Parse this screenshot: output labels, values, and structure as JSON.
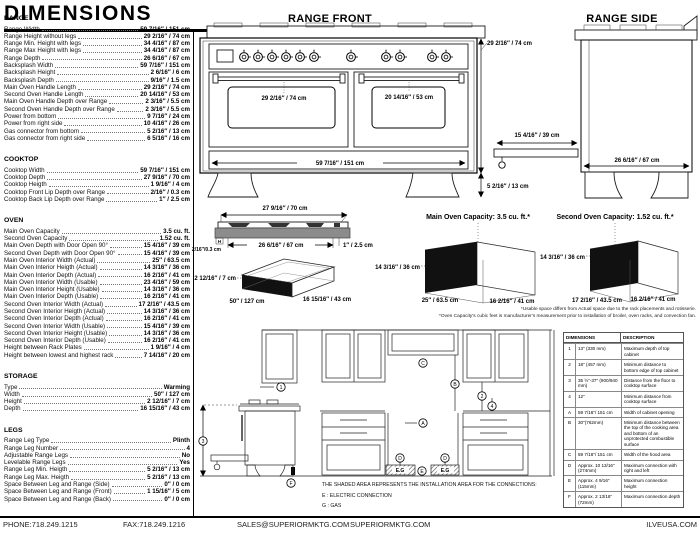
{
  "page_title": "DIMENSIONS",
  "specs": {
    "range": {
      "title": "RANGE",
      "rows": [
        {
          "label": "Range Width",
          "value": "59 7/16″ / 151 cm"
        },
        {
          "label": "Range Height without legs",
          "value": "29 2/16″ / 74 cm"
        },
        {
          "label": "Range Min. Height with legs",
          "value": "34 4/16″ / 87 cm"
        },
        {
          "label": "Range Max Height with legs",
          "value": "34 4/16″ / 87 cm"
        },
        {
          "label": "Range Depth",
          "value": "26 6/16″ / 67 cm"
        },
        {
          "label": "Backsplash Width",
          "value": "59 7/16″ / 151 cm"
        },
        {
          "label": "Backsplash Height",
          "value": "2 6/16″ / 6 cm"
        },
        {
          "label": "Backsplash Depth",
          "value": "9/16″ / 1.5 cm"
        },
        {
          "label": "Main Oven Handle Length",
          "value": "29 2/16″ / 74 cm"
        },
        {
          "label": "Second Oven Handle Length",
          "value": "20 14/16″ / 53 cm"
        },
        {
          "label": "Main Oven Handle Depth over Range",
          "value": "2 3/16″ / 5.5 cm"
        },
        {
          "label": "Second Oven Handle Depth over Range",
          "value": "2 3/16″ / 5.5 cm"
        },
        {
          "label": "Power from bottom",
          "value": "9 7/16″ / 24 cm"
        },
        {
          "label": "Power from right side",
          "value": "10 4/16″ / 26 cm"
        },
        {
          "label": "Gas connector from bottom",
          "value": "5 2/16″ / 13 cm"
        },
        {
          "label": "Gas connector from right side",
          "value": "6 5/16″ / 16 cm"
        }
      ]
    },
    "cooktop": {
      "title": "COOKTOP",
      "rows": [
        {
          "label": "Cooktop Width",
          "value": "59 7/16″ / 151 cm"
        },
        {
          "label": "Cooktop Depth",
          "value": "27 9/16″ / 70 cm"
        },
        {
          "label": "Cooktop Heigth",
          "value": "1 9/16″ / 4 cm"
        },
        {
          "label": "Cooktop Front Lip Depth over Range",
          "value": "2/16″ / 0.3 cm"
        },
        {
          "label": "Cooktop Back Lip Depth over Range",
          "value": "1″ / 2.5 cm"
        }
      ]
    },
    "oven": {
      "title": "OVEN",
      "rows": [
        {
          "label": "Main Oven Capacity",
          "value": "3.5 cu. ft."
        },
        {
          "label": "Second Oven Capacity",
          "value": "1.52 cu. ft."
        },
        {
          "label": "Main Oven Depth with Door Open 90°",
          "value": "15 4/16″ / 39 cm"
        },
        {
          "label": "Second Oven Depth with Door Open 90°",
          "value": "15 4/16″ / 39 cm"
        },
        {
          "label": "Main Oven Interior Width (Actual)",
          "value": "25″ / 63.5 cm"
        },
        {
          "label": "Main Oven Interior Heigth (Actual)",
          "value": "14 3/16″ / 36 cm"
        },
        {
          "label": "Main Oven Interior Depth (Actual)",
          "value": "16 2/16″ / 41 cm"
        },
        {
          "label": "Main Oven Interior Width (Usable)",
          "value": "23 4/16″ / 59 cm"
        },
        {
          "label": "Main Oven Interior Height (Usable)",
          "value": "14 3/16″ / 36 cm"
        },
        {
          "label": "Main Oven Interior Depth (Usable)",
          "value": "16 2/16″ / 41 cm"
        },
        {
          "label": "Second Oven Interior Width (Actual)",
          "value": "17 2/16″ / 43.5 cm"
        },
        {
          "label": "Second Oven Interior Heigth (Actual)",
          "value": "14 3/16″ / 36 cm"
        },
        {
          "label": "Second Oven Interior Depth (Actual)",
          "value": "16 2/16″ / 41 cm"
        },
        {
          "label": "Second Oven Interior Width (Usable)",
          "value": "15 4/16″ / 39 cm"
        },
        {
          "label": "Second Oven Interior Height (Usable)",
          "value": "14 3/16″ / 36 cm"
        },
        {
          "label": "Second Oven Interior Depth (Usable)",
          "value": "16 2/16″ / 41 cm"
        },
        {
          "label": "Height between Rack Plates",
          "value": "1 9/16″ / 4 cm"
        },
        {
          "label": "Height between lowest and highest rack",
          "value": "7 14/16″ / 20 cm"
        }
      ]
    },
    "storage": {
      "title": "STORAGE",
      "rows": [
        {
          "label": "Type",
          "value": "Warming"
        },
        {
          "label": "Width",
          "value": "50″ / 127 cm"
        },
        {
          "label": "Height",
          "value": "2 12/16″ / 7 cm"
        },
        {
          "label": "Depth",
          "value": "16 15/16″ / 43 cm"
        }
      ]
    },
    "legs": {
      "title": "LEGS",
      "rows": [
        {
          "label": "Range Leg Type",
          "value": "Plinth"
        },
        {
          "label": "Range Leg Number",
          "value": "4"
        },
        {
          "label": "Adjustable Range Legs",
          "value": "No"
        },
        {
          "label": "Levelable Range Legs",
          "value": "Yes"
        },
        {
          "label": "Range Leg Min. Heigth",
          "value": "5 2/16″ / 13 cm"
        },
        {
          "label": "Range Leg Max. Heigth",
          "value": "5 2/16″ / 13 cm"
        },
        {
          "label": "Space Between Leg and Range (Side)",
          "value": "0″ / 0 cm"
        },
        {
          "label": "Space Between Leg and Range (Front)",
          "value": "1 15/16″ / 5 cm"
        },
        {
          "label": "Space Between Leg and Range (Back)",
          "value": "0″ / 0 cm"
        }
      ]
    }
  },
  "front_diagram": {
    "title": "RANGE FRONT",
    "height_label": "29 2/16″ / 74 cm",
    "main_handle_label": "29 2/16″ / 74 cm",
    "second_handle_label": "20 14/16″ / 53 cm",
    "width_label": "59 7/16″ / 151 cm",
    "leg_height_label": "5 2/16″ / 13 cm"
  },
  "side_diagram": {
    "title": "RANGE SIDE",
    "depth_label": "26 6/16″ / 67 cm",
    "door_open_label": "15 4/16″ / 39 cm"
  },
  "cooktop_diagram": {
    "top_width_label": "27 9/16″ / 70 cm",
    "bottom_width_label": "26 6/16″ / 67 cm",
    "back_lip_label": "1″ / 2.5 cm",
    "front_lip_label": "2/16″/0.3 cm",
    "front_lip_pointer": "H"
  },
  "storage_diagram": {
    "height_label": "2 12/16″ / 7 cm",
    "width_label": "50″ / 127 cm",
    "depth_label": "16 15/16″ / 43 cm"
  },
  "main_oven_diagram": {
    "title": "Main Oven Capacity: 3.5 cu. ft.*",
    "height_label": "14 3/16″ / 36 cm",
    "width_label": "25″ / 63.5 cm",
    "depth_label": "16 2/16″ / 41 cm"
  },
  "second_oven_diagram": {
    "title": "Second Oven Capacity: 1.52 cu. ft.*",
    "height_label": "14 3/16″ / 36 cm",
    "width_label": "17 2/16″ / 43.5 cm",
    "depth_label": "16 2/16″ / 41 cm"
  },
  "footnotes": {
    "line1": "*Usable space differs from Actual space due to the rack placements and rotisserie.",
    "line2": "*Oven Capacity's cubic feet is manufacturer's measurement prior to installation of broiler, oven racks, and convection fan."
  },
  "installation": {
    "note": "THE SHADED AREA REPRESENTS THE INSTALLATION AREA FOR THE CONNECTIONS:",
    "legend_electric": "E : ELECTRIC CONNECTION",
    "legend_gas": "G : GAS",
    "connection_label": "E.G",
    "table": {
      "headers": [
        "DIMENSIONS",
        "DESCRIPTION"
      ],
      "rows": [
        {
          "ref": "1",
          "dimension": "13″ (330 mm)",
          "description": "Maximum depth of top cabinet"
        },
        {
          "ref": "2",
          "dimension": "18″ (457 mm)",
          "description": "Minimum distance to bottom edge of top cabinet"
        },
        {
          "ref": "3",
          "dimension": "35 ½″-37″ (900/940 mm)",
          "description": "Distance from the floor to cooktop surface"
        },
        {
          "ref": "4",
          "dimension": "12″",
          "description": "Minimum distance from cooktop surface"
        },
        {
          "ref": "A",
          "dimension": "59 7/16″/ 151 cm",
          "description": "Width of cabinet opening"
        },
        {
          "ref": "B",
          "dimension": "30″(762mm)",
          "description": "Minimum distance between the top of the cooking area and bottom of an unprotected combustible surface"
        },
        {
          "ref": "C",
          "dimension": "59 7/16″/ 151 cm",
          "description": "Width of the hood area"
        },
        {
          "ref": "D",
          "dimension": "Approx. 10 13/16″ (274mm)",
          "description": "Maximum connection with right and left"
        },
        {
          "ref": "E",
          "dimension": "Approx. 4 9/16″ (115mm)",
          "description": "Maximum connection height"
        },
        {
          "ref": "F",
          "dimension": "Approx. 2 13/16″ (72mm)",
          "description": "Maximum connection depth"
        }
      ]
    }
  },
  "footer": {
    "phone": "PHONE:718.249.1215",
    "fax": "FAX:718.249.1216",
    "email": "SALES@SUPERIORMKTG.COM",
    "site1": "SUPERIORMKTG.COM",
    "site2": "ILVEUSA.COM"
  }
}
